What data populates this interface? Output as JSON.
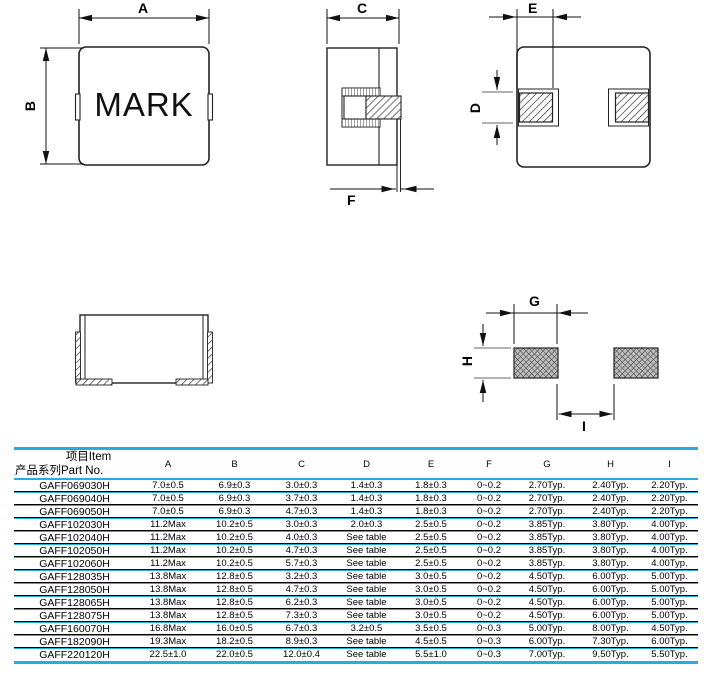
{
  "colors": {
    "accent": "#29abe2",
    "line": "#222222"
  },
  "drawings": {
    "top_view": {
      "mark_label": "MARK",
      "dim_a": "A",
      "dim_b": "B"
    },
    "side_view": {
      "dim_c": "C",
      "dim_f": "F"
    },
    "bottom_view": {
      "dim_e": "E",
      "dim_d": "D"
    },
    "land_pattern": {
      "dim_g": "G",
      "dim_h": "H",
      "dim_i": "I"
    }
  },
  "table": {
    "header": {
      "item_label": "项目Item",
      "part_no_label": "产品系列Part No.",
      "columns": [
        "A",
        "B",
        "C",
        "D",
        "E",
        "F",
        "G",
        "H",
        "I"
      ]
    },
    "rows": [
      {
        "part_no": "GAFF069030H",
        "values": [
          "7.0±0.5",
          "6.9±0.3",
          "3.0±0.3",
          "1.4±0.3",
          "1.8±0.3",
          "0~0.2",
          "2.70Typ.",
          "2.40Typ.",
          "2.20Typ."
        ]
      },
      {
        "part_no": "GAFF069040H",
        "values": [
          "7.0±0.5",
          "6.9±0.3",
          "3.7±0.3",
          "1.4±0.3",
          "1.8±0.3",
          "0~0.2",
          "2.70Typ.",
          "2.40Typ.",
          "2.20Typ."
        ]
      },
      {
        "part_no": "GAFF069050H",
        "values": [
          "7.0±0.5",
          "6.9±0.3",
          "4.7±0.3",
          "1.4±0.3",
          "1.8±0.3",
          "0~0.2",
          "2.70Typ.",
          "2.40Typ.",
          "2.20Typ."
        ]
      },
      {
        "part_no": "GAFF102030H",
        "values": [
          "11.2Max",
          "10.2±0.5",
          "3.0±0.3",
          "2.0±0.3",
          "2.5±0.5",
          "0~0.2",
          "3.85Typ.",
          "3.80Typ.",
          "4.00Typ."
        ]
      },
      {
        "part_no": "GAFF102040H",
        "values": [
          "11.2Max",
          "10.2±0.5",
          "4.0±0.3",
          "See table",
          "2.5±0.5",
          "0~0.2",
          "3.85Typ.",
          "3.80Typ.",
          "4.00Typ."
        ]
      },
      {
        "part_no": "GAFF102050H",
        "values": [
          "11.2Max",
          "10.2±0.5",
          "4.7±0.3",
          "See table",
          "2.5±0.5",
          "0~0.2",
          "3.85Typ.",
          "3.80Typ.",
          "4.00Typ."
        ]
      },
      {
        "part_no": "GAFF102060H",
        "values": [
          "11.2Max",
          "10.2±0.5",
          "5.7±0.3",
          "See table",
          "2.5±0.5",
          "0~0.2",
          "3.85Typ.",
          "3.80Typ.",
          "4.00Typ."
        ]
      },
      {
        "part_no": "GAFF128035H",
        "values": [
          "13.8Max",
          "12.8±0.5",
          "3.2±0.3",
          "See table",
          "3.0±0.5",
          "0~0.2",
          "4.50Typ.",
          "6.00Typ.",
          "5.00Typ."
        ]
      },
      {
        "part_no": "GAFF128050H",
        "values": [
          "13.8Max",
          "12.8±0.5",
          "4.7±0.3",
          "See table",
          "3.0±0.5",
          "0~0.2",
          "4.50Typ.",
          "6.00Typ.",
          "5.00Typ."
        ]
      },
      {
        "part_no": "GAFF128065H",
        "values": [
          "13.8Max",
          "12.8±0.5",
          "6.2±0.3",
          "See table",
          "3.0±0.5",
          "0~0.2",
          "4.50Typ.",
          "6.00Typ.",
          "5.00Typ."
        ]
      },
      {
        "part_no": "GAFF128075H",
        "values": [
          "13.8Max",
          "12.8±0.5",
          "7.3±0.3",
          "See table",
          "3.0±0.5",
          "0~0.2",
          "4.50Typ.",
          "6.00Typ.",
          "5.00Typ."
        ]
      },
      {
        "part_no": "GAFF160070H",
        "values": [
          "16.8Max",
          "16.0±0.5",
          "6.7±0.3",
          "3.2±0.5",
          "3.5±0.5",
          "0~0.3",
          "5.00Typ.",
          "8.00Typ.",
          "4.50Typ."
        ]
      },
      {
        "part_no": "GAFF182090H",
        "values": [
          "19.3Max",
          "18.2±0.5",
          "8.9±0.3",
          "See table",
          "4.5±0.5",
          "0~0.3",
          "6.00Typ.",
          "7.30Typ.",
          "6.00Typ."
        ]
      },
      {
        "part_no": "GAFF220120H",
        "values": [
          "22.5±1.0",
          "22.0±0.5",
          "12.0±0.4",
          "See table",
          "5.5±1.0",
          "0~0.3",
          "7.00Typ.",
          "9.50Typ.",
          "5.50Typ."
        ]
      }
    ]
  }
}
